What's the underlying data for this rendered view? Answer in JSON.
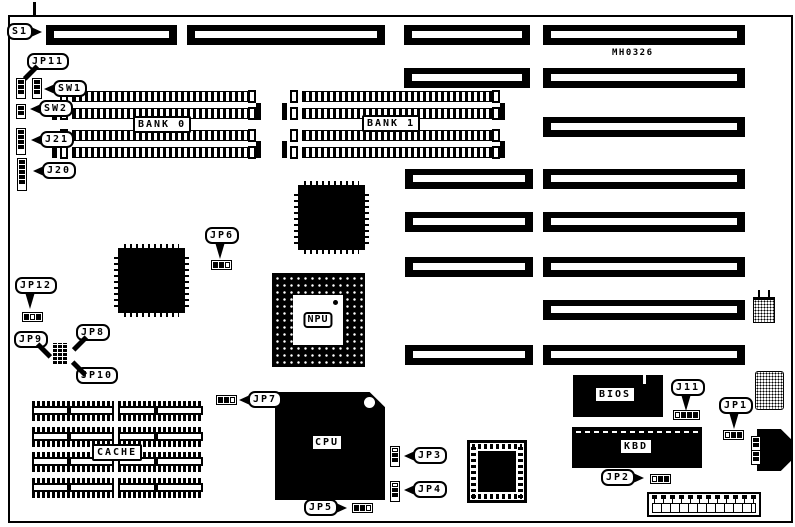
{
  "board": {
    "part_number": "MH0326",
    "colors": {
      "ink": "#000000",
      "bg": "#ffffff"
    }
  },
  "chips": {
    "npu": "NPU",
    "cpu": "CPU",
    "bios": "BIOS",
    "kbd": "KBD",
    "cache": "CACHE"
  },
  "callouts": [
    {
      "id": "s1",
      "label": "S1",
      "x": 7,
      "y": 23,
      "tail": "right"
    },
    {
      "id": "jp11",
      "label": "JP11",
      "x": 27,
      "y": 53,
      "tail": "down-left"
    },
    {
      "id": "sw1",
      "label": "SW1",
      "x": 53,
      "y": 80,
      "tail": "left"
    },
    {
      "id": "sw2",
      "label": "SW2",
      "x": 39,
      "y": 100,
      "tail": "left"
    },
    {
      "id": "j21",
      "label": "J21",
      "x": 40,
      "y": 131,
      "tail": "left"
    },
    {
      "id": "j20",
      "label": "J20",
      "x": 42,
      "y": 162,
      "tail": "left"
    },
    {
      "id": "jp6",
      "label": "JP6",
      "x": 205,
      "y": 227,
      "tail": "down"
    },
    {
      "id": "jp12",
      "label": "JP12",
      "x": 15,
      "y": 277,
      "tail": "down"
    },
    {
      "id": "jp9",
      "label": "JP9",
      "x": 14,
      "y": 331,
      "tail": "down-right"
    },
    {
      "id": "jp8",
      "label": "JP8",
      "x": 76,
      "y": 324,
      "tail": "down-left"
    },
    {
      "id": "jp10",
      "label": "JP10",
      "x": 76,
      "y": 367,
      "tail": "up-left"
    },
    {
      "id": "jp7",
      "label": "JP7",
      "x": 248,
      "y": 391,
      "tail": "left"
    },
    {
      "id": "jp3",
      "label": "JP3",
      "x": 413,
      "y": 447,
      "tail": "left"
    },
    {
      "id": "jp4",
      "label": "JP4",
      "x": 413,
      "y": 481,
      "tail": "left"
    },
    {
      "id": "jp5",
      "label": "JP5",
      "x": 304,
      "y": 499,
      "tail": "right"
    },
    {
      "id": "jp2",
      "label": "JP2",
      "x": 601,
      "y": 469,
      "tail": "right"
    },
    {
      "id": "j11",
      "label": "J11",
      "x": 671,
      "y": 379,
      "tail": "down"
    },
    {
      "id": "jp1",
      "label": "JP1",
      "x": 719,
      "y": 397,
      "tail": "down"
    }
  ],
  "slots": [
    {
      "x": 46,
      "y": 25,
      "w": 131
    },
    {
      "x": 187,
      "y": 25,
      "w": 198
    },
    {
      "x": 404,
      "y": 25,
      "w": 126
    },
    {
      "x": 543,
      "y": 25,
      "w": 202
    },
    {
      "x": 404,
      "y": 68,
      "w": 126
    },
    {
      "x": 543,
      "y": 68,
      "w": 202
    },
    {
      "x": 543,
      "y": 117,
      "w": 202
    },
    {
      "x": 405,
      "y": 169,
      "w": 128
    },
    {
      "x": 543,
      "y": 169,
      "w": 202
    },
    {
      "x": 405,
      "y": 212,
      "w": 128
    },
    {
      "x": 543,
      "y": 212,
      "w": 202
    },
    {
      "x": 405,
      "y": 257,
      "w": 128
    },
    {
      "x": 543,
      "y": 257,
      "w": 202
    },
    {
      "x": 543,
      "y": 300,
      "w": 202
    },
    {
      "x": 405,
      "y": 345,
      "w": 128
    },
    {
      "x": 543,
      "y": 345,
      "w": 202
    }
  ],
  "simm_banks": [
    {
      "label": "BANK 0",
      "x": 48,
      "y": 91,
      "w": 214,
      "label_x": 133,
      "label_y": 116
    },
    {
      "label": "BANK 1",
      "x": 278,
      "y": 91,
      "w": 228,
      "label_x": 362,
      "label_y": 115
    }
  ],
  "bank_row_offsets": [
    0,
    17,
    39,
    56
  ],
  "cache": {
    "x": 32,
    "y": 401,
    "rows": [
      0,
      26,
      51,
      77
    ],
    "cols": [
      {
        "x": 0,
        "w": 82
      },
      {
        "x": 86,
        "w": 85
      }
    ],
    "cell_h": 20,
    "label_x": 92,
    "label_y": 444
  },
  "qfp_chips": [
    {
      "x": 298,
      "y": 185,
      "w": 67,
      "h": 65
    },
    {
      "x": 118,
      "y": 248,
      "w": 67,
      "h": 65
    }
  ],
  "jumpers": [
    {
      "id": "jp11-header",
      "x": 16,
      "y": 78,
      "dir": "v",
      "pins": [
        1,
        1,
        1
      ]
    },
    {
      "id": "sw1-header",
      "x": 32,
      "y": 78,
      "dir": "v",
      "pins": [
        1,
        1,
        1
      ]
    },
    {
      "id": "sw2-header",
      "x": 16,
      "y": 104,
      "dir": "v",
      "pins": [
        1,
        1
      ]
    },
    {
      "id": "j21-header",
      "x": 16,
      "y": 128,
      "dir": "v",
      "pins": [
        1,
        1,
        1,
        1
      ]
    },
    {
      "id": "j20-header",
      "x": 17,
      "y": 158,
      "dir": "v",
      "pins": [
        1,
        1,
        1,
        1,
        1
      ]
    },
    {
      "id": "jp6-header",
      "x": 211,
      "y": 260,
      "dir": "h",
      "pins": [
        1,
        1,
        0
      ]
    },
    {
      "id": "jp12-header",
      "x": 22,
      "y": 312,
      "dir": "h",
      "pins": [
        1,
        0,
        1
      ]
    },
    {
      "id": "jp7-header",
      "x": 216,
      "y": 395,
      "dir": "h",
      "pins": [
        1,
        1,
        0
      ]
    },
    {
      "id": "jp3-header",
      "x": 390,
      "y": 446,
      "dir": "v",
      "pins": [
        0,
        1,
        1
      ]
    },
    {
      "id": "jp4-header",
      "x": 390,
      "y": 481,
      "dir": "v",
      "pins": [
        0,
        1,
        1
      ]
    },
    {
      "id": "jp5-header",
      "x": 352,
      "y": 503,
      "dir": "h",
      "pins": [
        1,
        1,
        0
      ]
    },
    {
      "id": "j11-header",
      "x": 673,
      "y": 410,
      "dir": "h",
      "pins": [
        0,
        1,
        1,
        1
      ]
    },
    {
      "id": "jp1-header",
      "x": 723,
      "y": 430,
      "dir": "h",
      "pins": [
        0,
        1,
        1
      ]
    },
    {
      "id": "jp2-header",
      "x": 650,
      "y": 474,
      "dir": "h",
      "pins": [
        0,
        1,
        1
      ]
    },
    {
      "id": "din-nub-1",
      "x": 751,
      "y": 436,
      "dir": "v",
      "pins": [
        1,
        1
      ]
    },
    {
      "id": "din-nub-2",
      "x": 751,
      "y": 450,
      "dir": "v",
      "pins": [
        1,
        1
      ]
    }
  ],
  "pin_block": {
    "x": 53,
    "y": 343,
    "w": 15,
    "h": 21
  }
}
